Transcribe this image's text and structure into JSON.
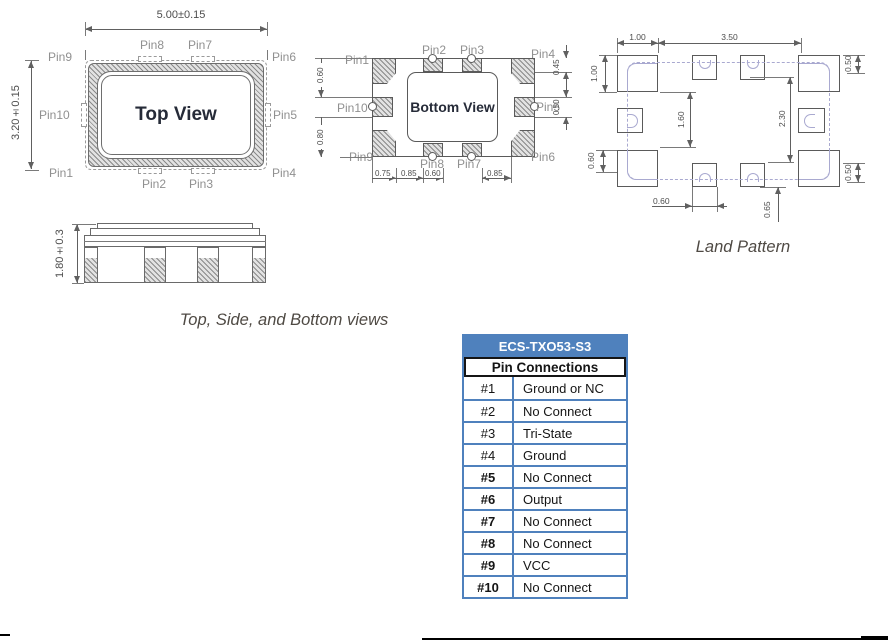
{
  "pin_labels": {
    "p1": "Pin1",
    "p2": "Pin2",
    "p3": "Pin3",
    "p4": "Pin4",
    "p5": "Pin5",
    "p6": "Pin6",
    "p7": "Pin7",
    "p8": "Pin8",
    "p9": "Pin9",
    "p10": "Pin10"
  },
  "top_view": {
    "label": "Top View",
    "width_dim": "5.00±0.15",
    "height_dim": "3.20±0.15"
  },
  "side_view": {
    "height_dim": "1.80±0.3"
  },
  "bottom_view": {
    "label": "Bottom View",
    "dims": {
      "left_top": "0.60",
      "left_bottom": "0.80",
      "right_top": "0.45",
      "right_mid": "0.50",
      "b1": "0.75",
      "b2": "0.85",
      "b3": "0.60",
      "b4": "0.85"
    }
  },
  "land_pattern": {
    "caption": "Land Pattern",
    "dims": {
      "pad_w": "1.00",
      "span": "3.50",
      "pad_h": "1.00",
      "left_low": "0.60",
      "inner_left": "1.60",
      "inner_right": "2.30",
      "right_top": "0.50",
      "right_bottom": "0.50",
      "bottom": "0.60",
      "bottom_right": "0.65"
    }
  },
  "captions": {
    "views": "Top, Side, and Bottom views"
  },
  "table": {
    "title": "ECS-TXO53-S3",
    "subtitle": "Pin Connections",
    "rows": [
      {
        "pin": "#1",
        "conn": "Ground or NC"
      },
      {
        "pin": "#2",
        "conn": "No Connect"
      },
      {
        "pin": "#3",
        "conn": "Tri-State"
      },
      {
        "pin": "#4",
        "conn": "Ground"
      },
      {
        "pin": "#5",
        "conn": "No Connect"
      },
      {
        "pin": "#6",
        "conn": "Output"
      },
      {
        "pin": "#7",
        "conn": "No Connect"
      },
      {
        "pin": "#8",
        "conn": "No Connect"
      },
      {
        "pin": "#9",
        "conn": "VCC"
      },
      {
        "pin": "#10",
        "conn": "No Connect"
      }
    ]
  },
  "colors": {
    "table_header_bg": "#4f81bd",
    "table_header_text": "#ffffff",
    "land_overlay": "#a9a9d0",
    "line": "#606060",
    "pin_label": "#909090"
  }
}
